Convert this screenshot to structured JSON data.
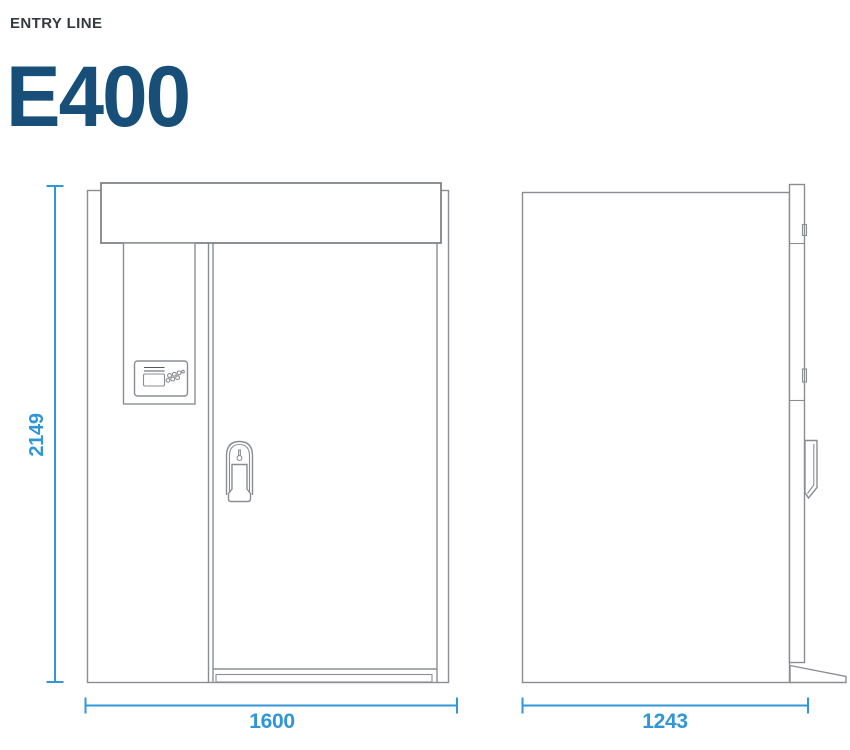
{
  "header": {
    "series_label": "ENTRY LINE",
    "model_name": "E400"
  },
  "dimensions": {
    "height": "2149",
    "width": "1600",
    "depth": "1243"
  },
  "colors": {
    "dimension_accent": "#2F96D7",
    "model_title": "#174F78",
    "series_label": "#343A40",
    "drawing_line": "#8A8E93"
  },
  "icons": {
    "card_reader": "card-reader-icon",
    "keypad": "keypad-dots-icon",
    "keyhole": "keyhole-icon",
    "door_handle": "door-handle-icon"
  }
}
